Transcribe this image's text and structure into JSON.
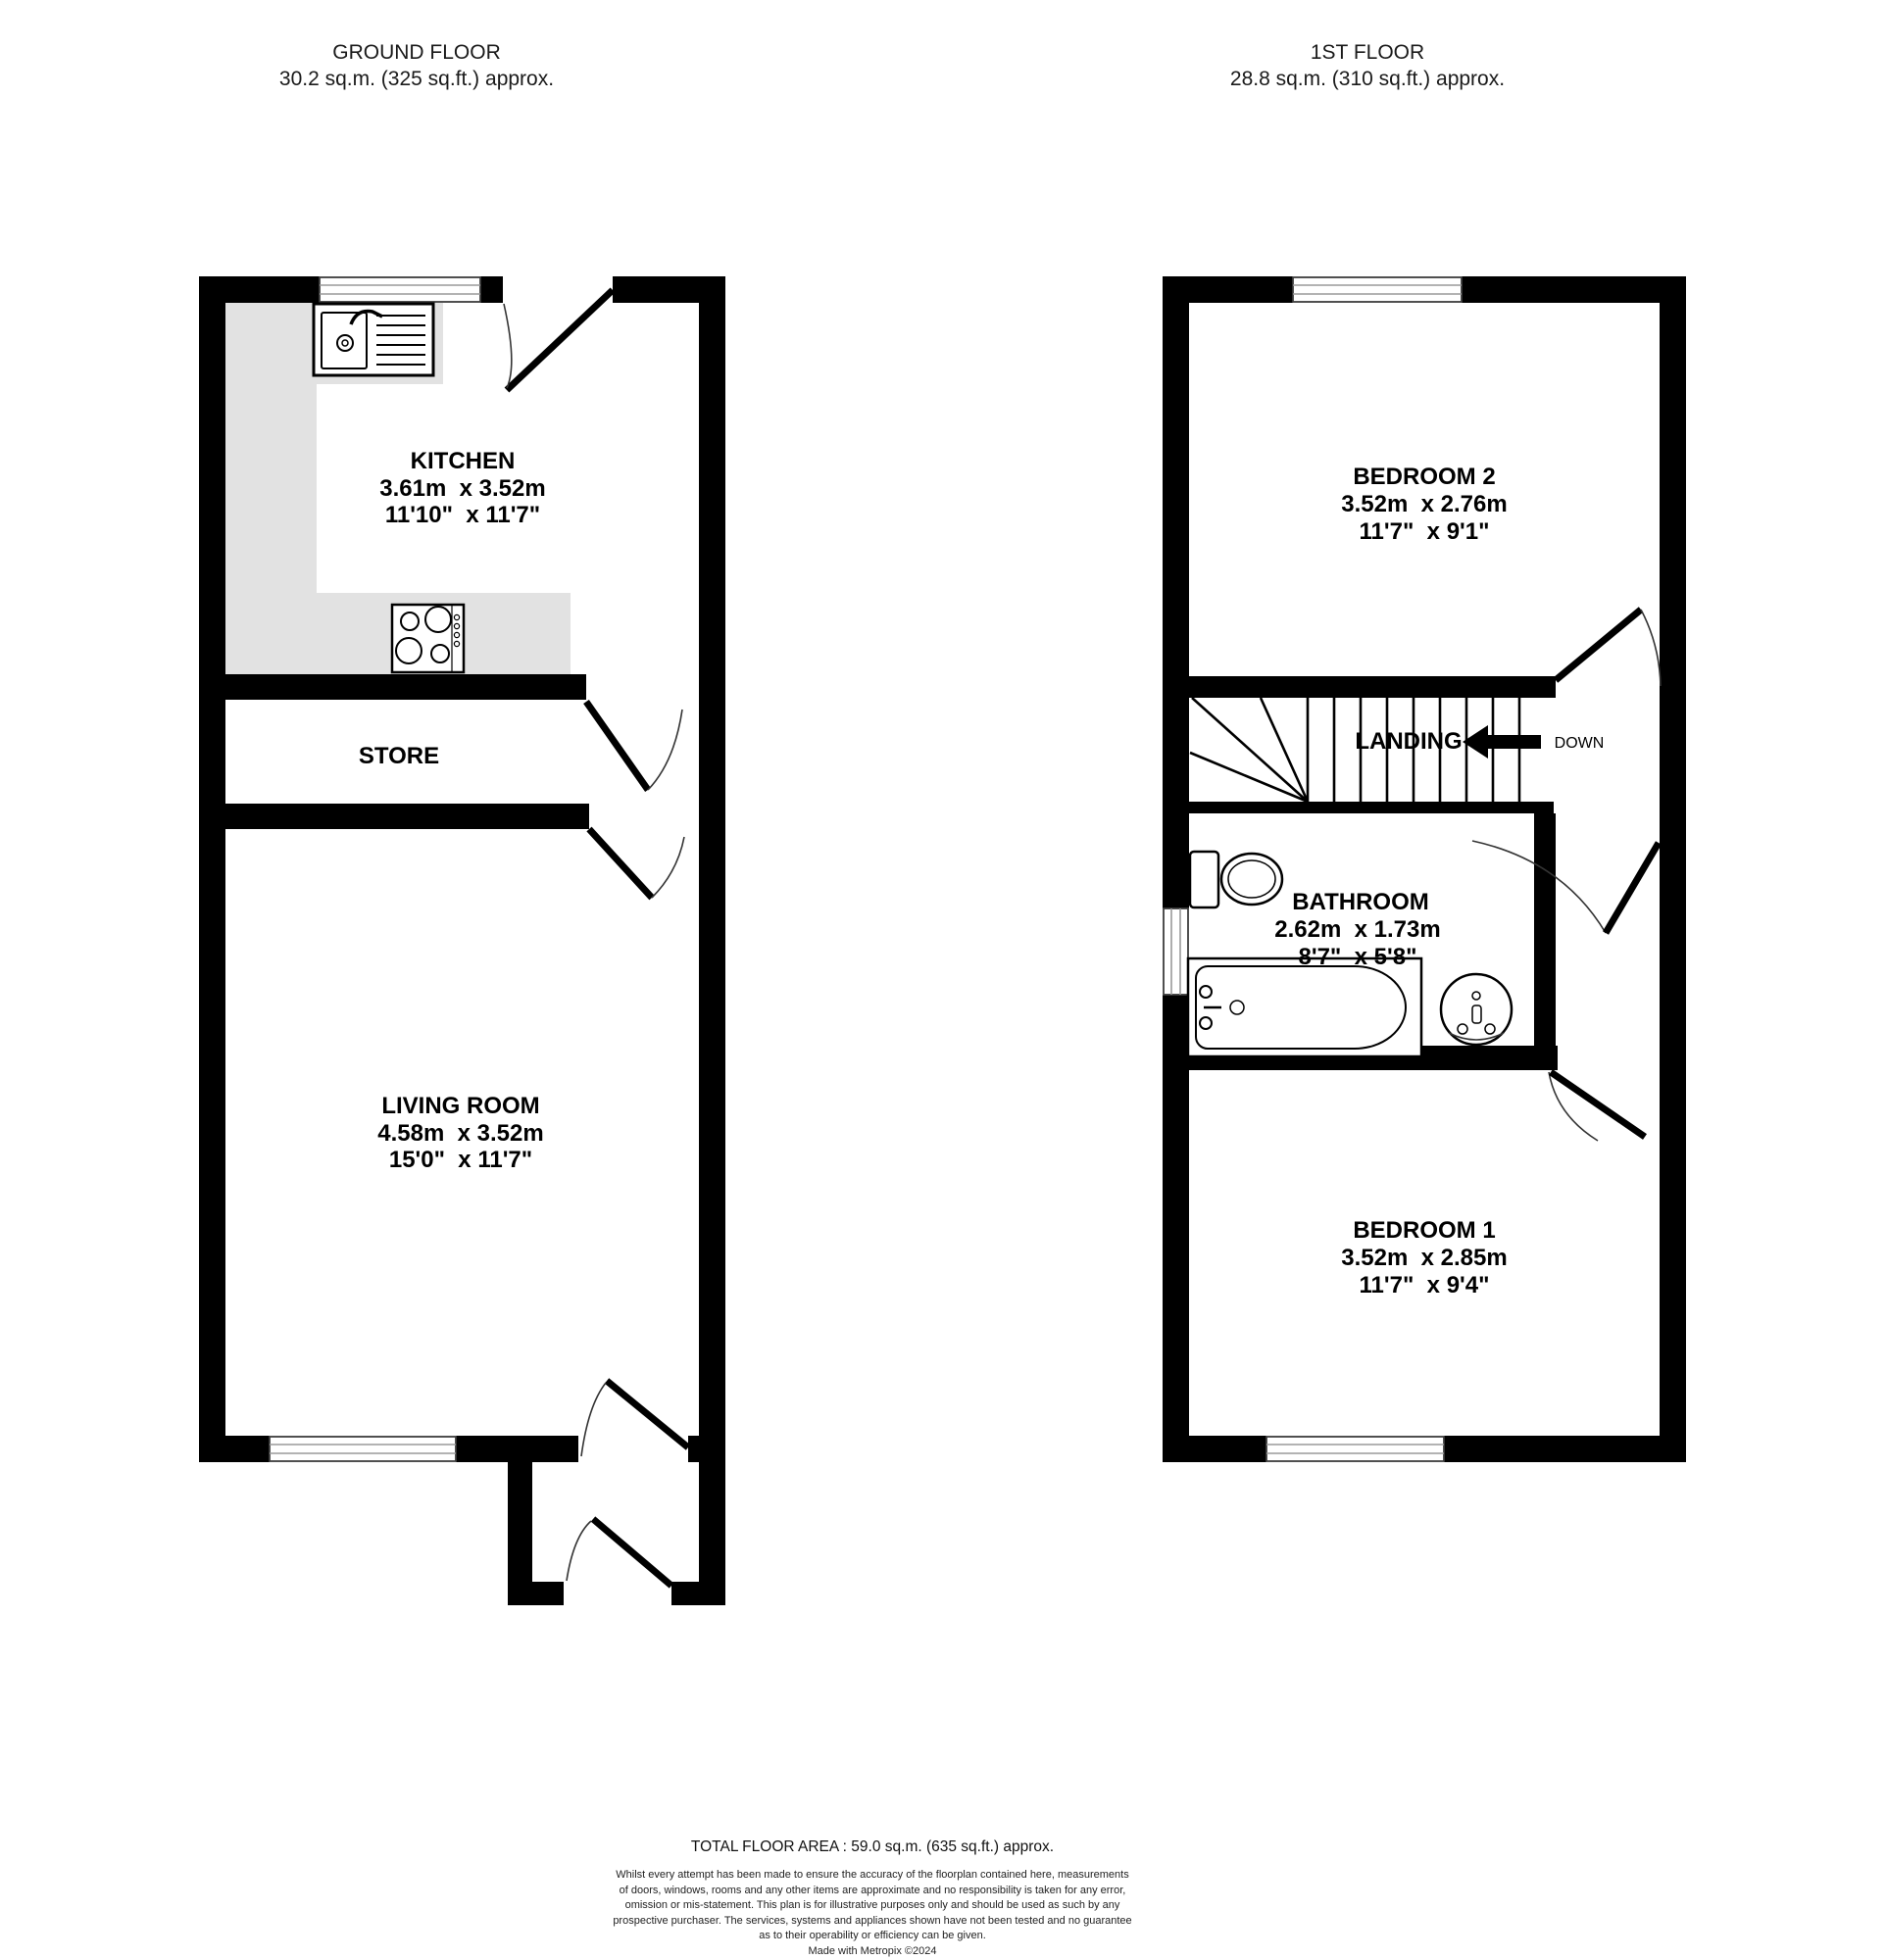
{
  "ground_floor": {
    "title": "GROUND FLOOR",
    "area_label": "30.2 sq.m. (325 sq.ft.) approx.",
    "kitchen": {
      "name": "KITCHEN",
      "dims_metric": "3.61m  x 3.52m",
      "dims_imperial": "11'10\"  x 11'7\""
    },
    "store": {
      "name": "STORE"
    },
    "living_room": {
      "name": "LIVING ROOM",
      "dims_metric": "4.58m  x 3.52m",
      "dims_imperial": "15'0\"  x 11'7\""
    }
  },
  "first_floor": {
    "title": "1ST FLOOR",
    "area_label": "28.8 sq.m. (310 sq.ft.) approx.",
    "bedroom2": {
      "name": "BEDROOM 2",
      "dims_metric": "3.52m  x 2.76m",
      "dims_imperial": "11'7\"  x 9'1\""
    },
    "landing": {
      "name": "LANDING",
      "down_label": "DOWN"
    },
    "bathroom": {
      "name": "BATHROOM",
      "dims_metric": "2.62m  x 1.73m",
      "dims_imperial": "8'7\"  x 5'8\""
    },
    "bedroom1": {
      "name": "BEDROOM 1",
      "dims_metric": "3.52m  x 2.85m",
      "dims_imperial": "11'7\"  x 9'4\""
    }
  },
  "footer": {
    "total_area": "TOTAL FLOOR AREA : 59.0 sq.m. (635 sq.ft.) approx.",
    "disclaimer_lines": [
      "Whilst every attempt has been made to ensure the accuracy of the floorplan contained here, measurements",
      "of doors, windows, rooms and any other items are approximate and no responsibility is taken for any error,",
      "omission or mis-statement. This plan is for illustrative purposes only and should be used as such by any",
      "prospective purchaser. The services, systems and appliances shown have not been tested and no guarantee",
      "as to their operability or efficiency can be given."
    ],
    "credit": "Made with Metropix ©2024"
  },
  "colors": {
    "wall": "#000000",
    "counter": "#e2e2e2",
    "background": "#ffffff"
  }
}
